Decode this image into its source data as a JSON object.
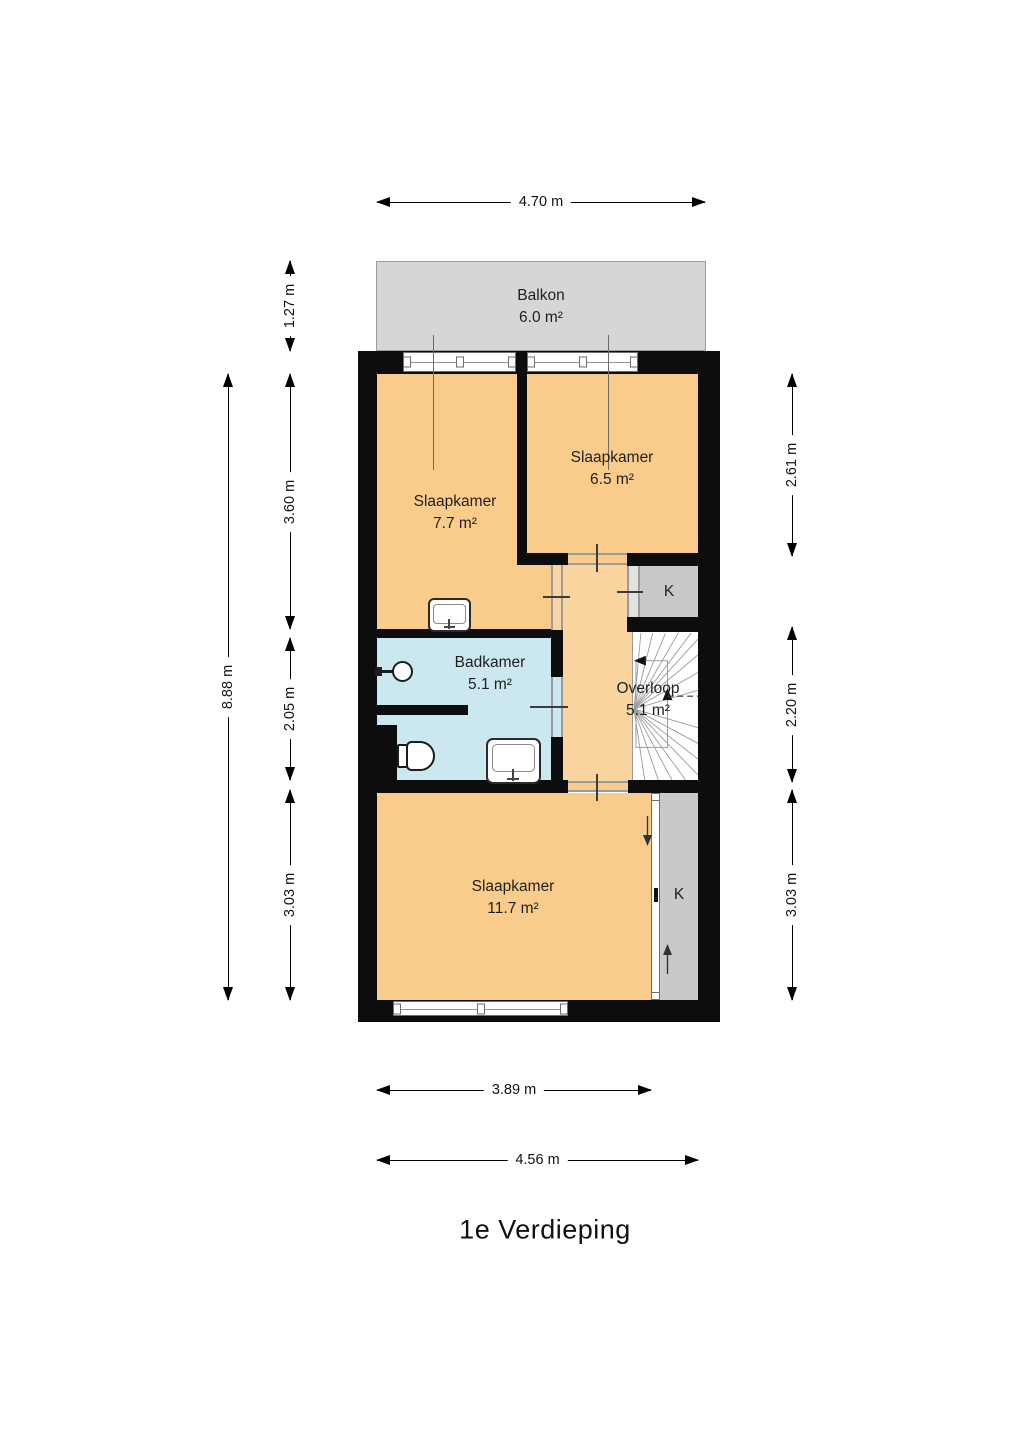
{
  "title": "1e Verdieping",
  "rooms": {
    "balkon": {
      "name": "Balkon",
      "area": "6.0 m²"
    },
    "slaapkamer_links": {
      "name": "Slaapkamer",
      "area": "7.7 m²"
    },
    "slaapkamer_rechts": {
      "name": "Slaapkamer",
      "area": "6.5 m²"
    },
    "badkamer": {
      "name": "Badkamer",
      "area": "5.1 m²"
    },
    "overloop": {
      "name": "Overloop",
      "area": "5.1 m²"
    },
    "slaapkamer_groot": {
      "name": "Slaapkamer",
      "area": "11.7 m²"
    },
    "kast_midden": {
      "name": "K"
    },
    "kast_onder": {
      "name": "K"
    }
  },
  "dimensions": {
    "top": "4.70 m",
    "left_total": "8.88 m",
    "left_balkon": "1.27 m",
    "left_boven": "3.60 m",
    "left_midden": "2.05 m",
    "left_onder": "3.03 m",
    "right_boven": "2.61 m",
    "right_midden": "2.20 m",
    "right_onder": "3.03 m",
    "bottom_inner": "3.89 m",
    "bottom_outer": "4.56 m"
  },
  "colors": {
    "wall": "#0d0d0d",
    "room": "#FACC8C",
    "hall": "#FBD5A0",
    "bath": "#CBE7F0",
    "balcony": "#D6D6D6",
    "closet": "#C9C9C9",
    "door_kast": "#E2E2E2"
  }
}
